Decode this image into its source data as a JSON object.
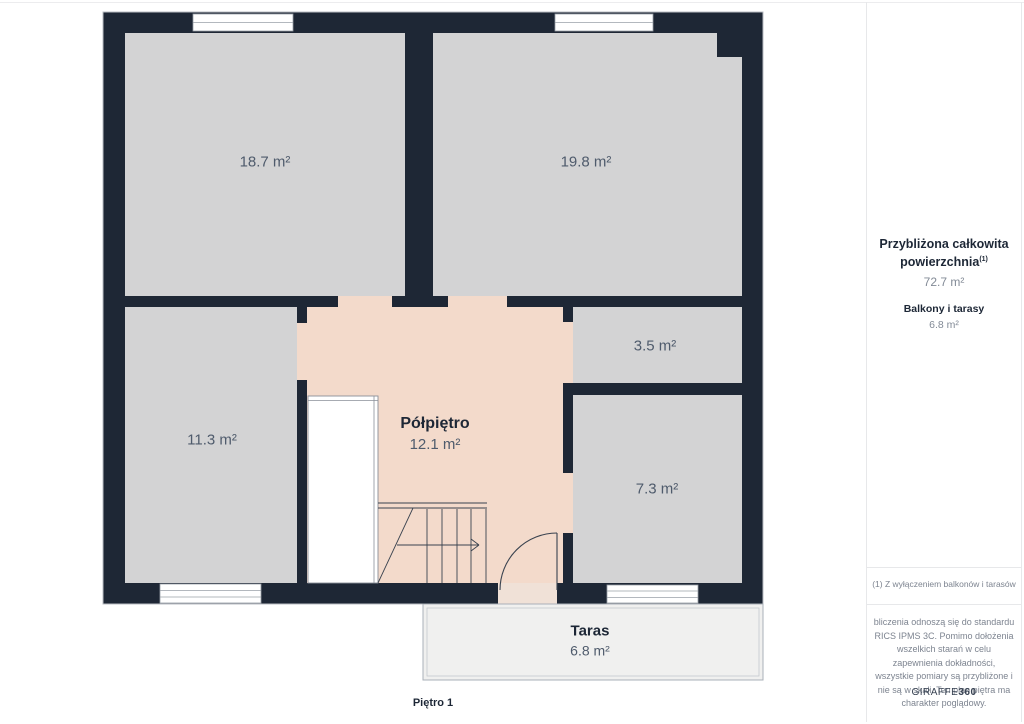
{
  "page": {
    "floor_label": "Piętro 1"
  },
  "plan": {
    "rooms": [
      {
        "id": "room-18-7",
        "area": "18.7 m²"
      },
      {
        "id": "room-19-8",
        "area": "19.8 m²"
      },
      {
        "id": "room-11-3",
        "area": "11.3 m²"
      },
      {
        "id": "room-3-5",
        "area": "3.5 m²"
      },
      {
        "id": "room-7-3",
        "area": "7.3 m²"
      },
      {
        "id": "polpietro",
        "name": "Półpiętro",
        "area": "12.1 m²"
      },
      {
        "id": "taras",
        "name": "Taras",
        "area": "6.8 m²"
      }
    ]
  },
  "sidebar": {
    "total_label_line1": "Przybliżona całkowita",
    "total_label_line2": "powierzchnia",
    "total_superscript": "(1)",
    "total_value": "72.7 m²",
    "balconies_label": "Balkony i tarasy",
    "balconies_value": "6.8 m²",
    "footnote": "(1) Z wyłączeniem balkonów i tarasów",
    "disclaimer": "bliczenia odnoszą się do standardu RICS IPMS 3C. Pomimo dołożenia wszelkich starań w celu zapewnienia dokładności, wszystkie pomiary są przybliżone i nie są w skali. Ten plan piętra ma charakter poglądowy.",
    "brand_name": "GIRAFFE",
    "brand_suffix": "360"
  },
  "colors": {
    "wall": "#1e2735",
    "room_fill": "#d3d3d4",
    "landing_fill": "#f3dacb",
    "terrace_fill": "#f0f0ef",
    "door_floor": "#f0e1d7",
    "line": "#39424f",
    "text_dark": "#1d2736",
    "text_muted": "#4f5b6c",
    "sidebar_muted": "#828a96",
    "border_light": "#e7e8ea"
  }
}
